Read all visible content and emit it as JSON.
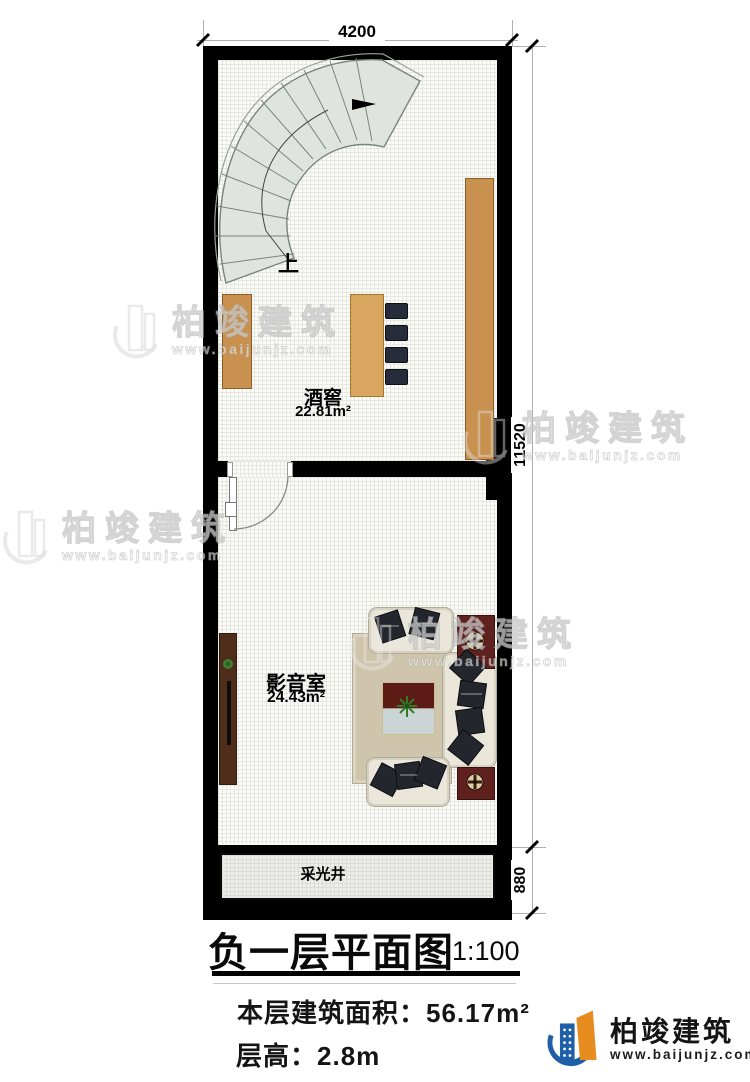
{
  "plan": {
    "title": "负一层平面图",
    "scale": "1:100",
    "stats": {
      "area_label": "本层建筑面积：",
      "area_value": "56.17m²",
      "height_label": "层高：",
      "height_value": "2.8m"
    },
    "dimensions": {
      "top_width": "4200",
      "right_height": "11520",
      "right_lightwell": "880"
    },
    "rooms": {
      "wine_cellar": {
        "name": "酒窖",
        "area": "22.81m²"
      },
      "media_room": {
        "name": "影音室",
        "area": "24.43m²"
      },
      "light_well": {
        "name": "采光井"
      }
    },
    "stairs": {
      "up_label": "上"
    }
  },
  "watermark": {
    "brand": "柏竣建筑",
    "url": "www.baijunjz.com"
  },
  "logo": {
    "brand": "柏竣建筑",
    "url": "www.baijunjz.com"
  },
  "colors": {
    "wall": "#000000",
    "wood": "#c8914f",
    "stair_fill": "#dfe5de",
    "mat_red": "#5e211e",
    "logo_blue": "#1f5fa8",
    "logo_orange": "#e78c1e"
  }
}
